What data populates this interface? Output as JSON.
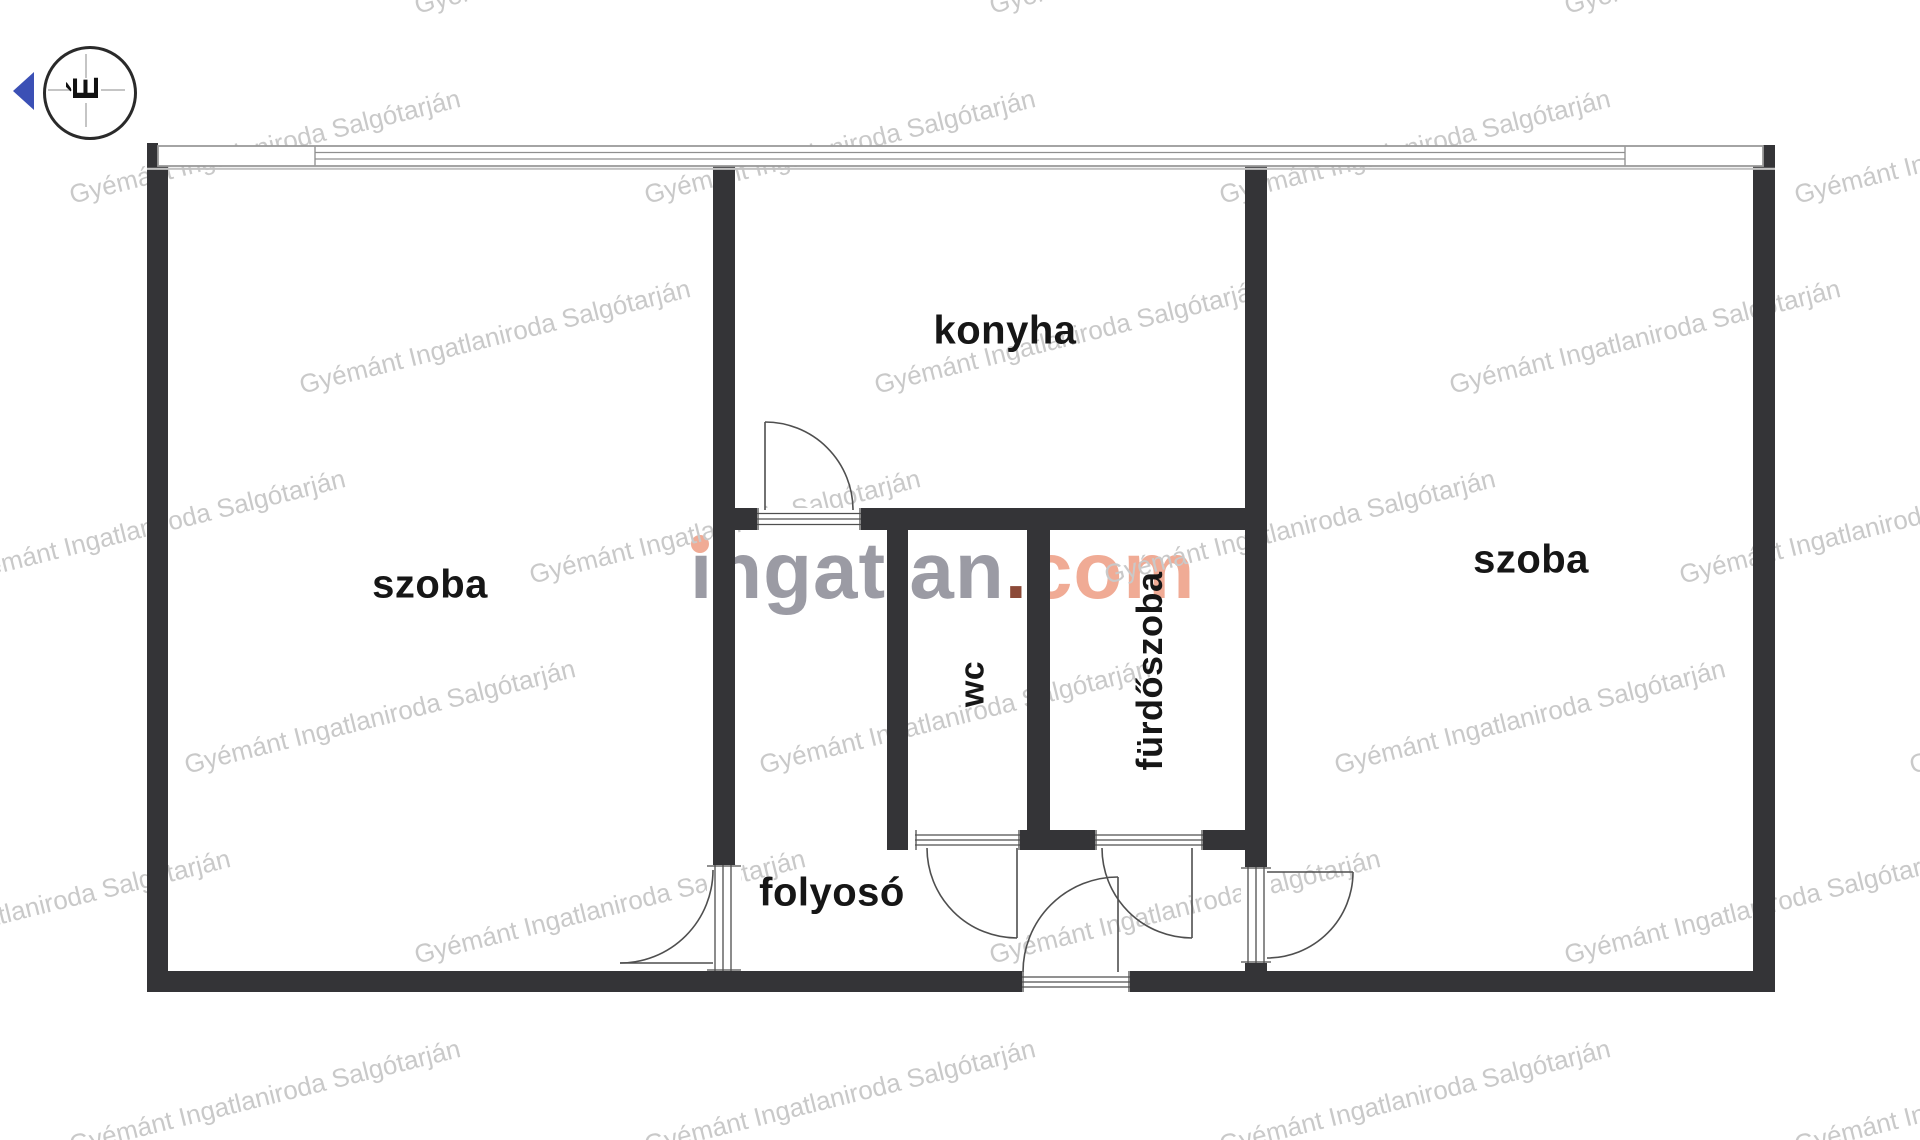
{
  "title": "apartment floor plan",
  "compass": {
    "north_label": "É",
    "arrow_color": "#3b50b5"
  },
  "rooms": {
    "room_left": "szoba",
    "kitchen": "konyha",
    "wc": "wc",
    "bathroom": "fürdőszoba",
    "hallway": "folyosó",
    "room_right": "szoba"
  },
  "watermark": {
    "tile_text": "Gyémánt Ingatlaniroda Salgótarján",
    "logo_part_name": "ingatlan",
    "logo_part_dot": ".",
    "logo_part_tld": "com",
    "colors": {
      "tile": "#c9c9c9",
      "logo_name": "#9b9ba4",
      "logo_dot": "#8c4a38",
      "logo_tld": "#f0ab95"
    }
  },
  "plan_colors": {
    "wall": "#343437",
    "door_line": "#4f4f4f",
    "window_line": "#9a9a9a"
  }
}
